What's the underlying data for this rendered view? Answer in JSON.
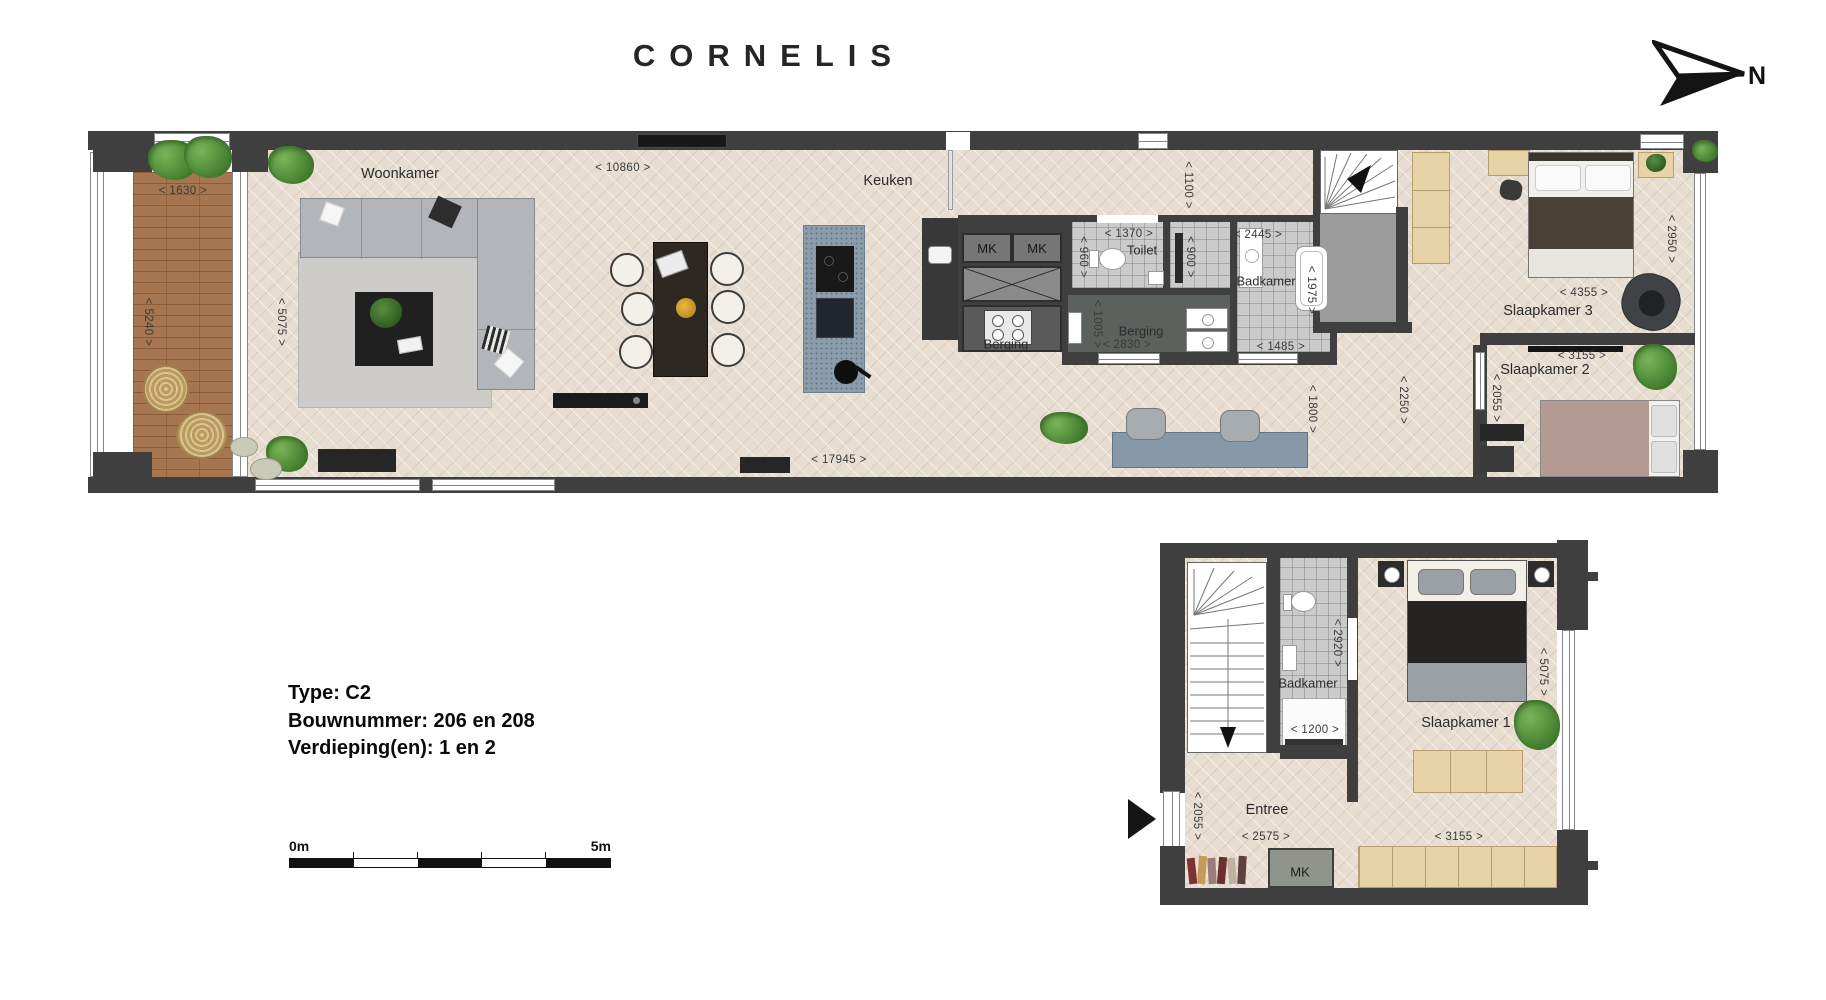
{
  "header": {
    "logo": "CORNELIS",
    "north_label": "N"
  },
  "floor1": {
    "rooms": {
      "woonkamer": "Woonkamer",
      "keuken": "Keuken",
      "toilet": "Toilet",
      "badkamer": "Badkamer",
      "berging_klein": "Berging",
      "berging": "Berging",
      "slaapkamer3": "Slaapkamer 3",
      "slaapkamer2": "Slaapkamer 2",
      "mk1": "MK",
      "mk2": "MK"
    },
    "dims": {
      "d10860": "< 10860 >",
      "d1630": "< 1630 >",
      "d5240": "< 5240 >",
      "d5075": "< 5075 >",
      "d1370": "< 1370 >",
      "d960": "< 960 >",
      "d900": "< 900 >",
      "d1100": "< 1100 >",
      "d2445": "< 2445 >",
      "d1975": "< 1975 >",
      "d1005": "< 1005 >",
      "d2830": "< 2830 >",
      "d1485": "< 1485 >",
      "d1800": "< 1800 >",
      "d2250": "< 2250 >",
      "d2055": "< 2055 >",
      "d4355": "< 4355 >",
      "d2950": "< 2950 >",
      "d3155": "< 3155 >",
      "d17945": "< 17945 >"
    }
  },
  "floor2": {
    "rooms": {
      "badkamer": "Badkamer",
      "slaapkamer1": "Slaapkamer 1",
      "entree": "Entree",
      "mk": "MK"
    },
    "dims": {
      "d2920": "< 2920 >",
      "d1200": "< 1200 >",
      "d5075": "< 5075 >",
      "d3155": "< 3155 >",
      "d2055": "< 2055 >",
      "d2575": "< 2575 >"
    }
  },
  "info": {
    "type": "Type: C2",
    "bouwnummer": "Bouwnummer: 206 en 208",
    "verdieping": "Verdieping(en): 1 en 2"
  },
  "scalebar": {
    "start": "0m",
    "end": "5m"
  },
  "colors": {
    "wall": "#3f3f3f",
    "floor": "#e8ddd1",
    "deck": "#a5764f",
    "tile": "#cbcbcb",
    "plant": "#4e8f3a"
  }
}
